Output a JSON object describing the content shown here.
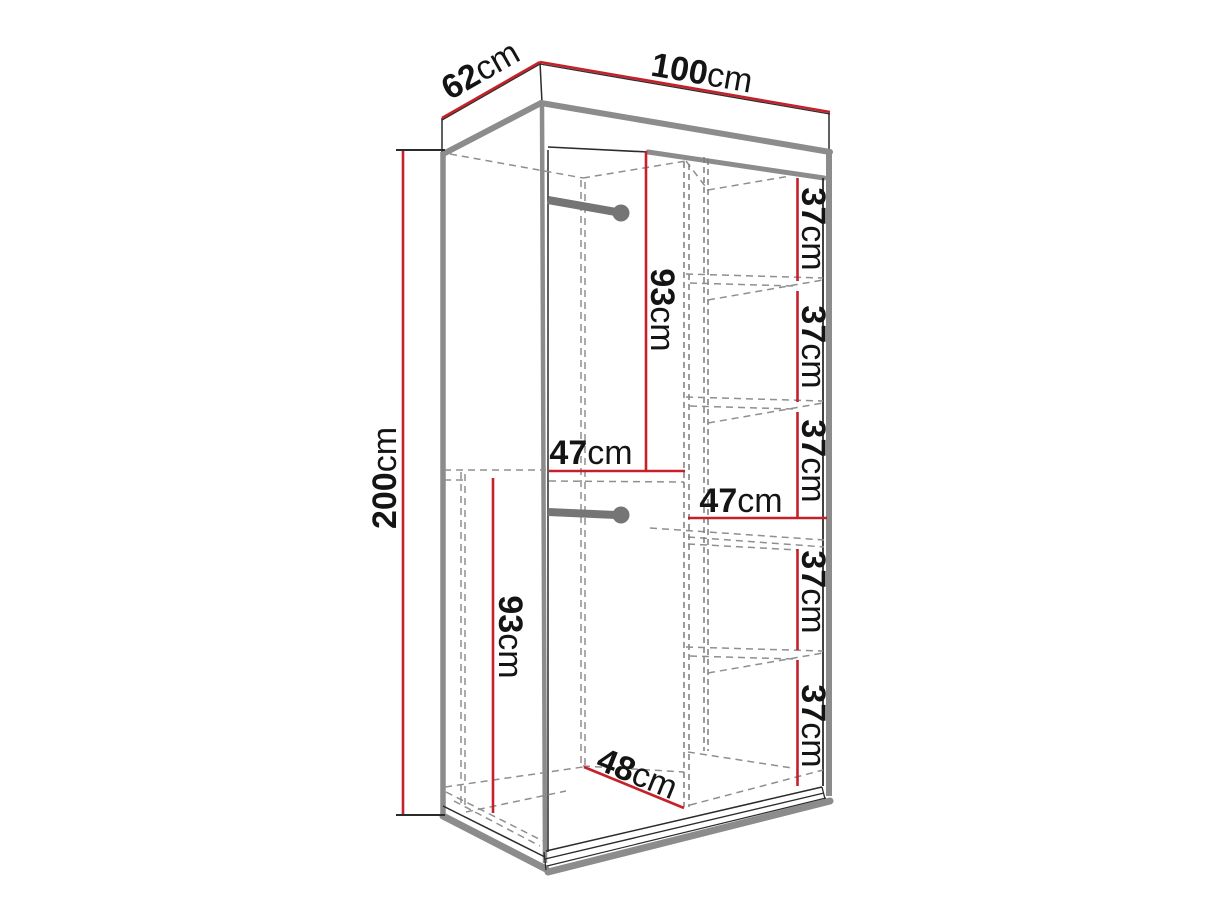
{
  "title": "Wardrobe dimension diagram",
  "colors": {
    "dimension_red": "#c5212a",
    "outline_black": "#2b2b2b",
    "panel_gray": "#8c8c8c",
    "rod_gray": "#757575",
    "hidden_dash_gray": "#8f8f8f",
    "text": "#141414",
    "background": "#ffffff"
  },
  "labels": {
    "depth": {
      "value": "62",
      "unit": "cm"
    },
    "width": {
      "value": "100",
      "unit": "cm"
    },
    "height": {
      "value": "200",
      "unit": "cm"
    },
    "hang_top": {
      "value": "93",
      "unit": "cm"
    },
    "hang_bottom": {
      "value": "93",
      "unit": "cm"
    },
    "inner_width_left": {
      "value": "47",
      "unit": "cm"
    },
    "inner_width_right": {
      "value": "47",
      "unit": "cm"
    },
    "floor_width": {
      "value": "48",
      "unit": "cm"
    },
    "shelves": [
      {
        "value": "37",
        "unit": "cm"
      },
      {
        "value": "37",
        "unit": "cm"
      },
      {
        "value": "37",
        "unit": "cm"
      },
      {
        "value": "37",
        "unit": "cm"
      },
      {
        "value": "37",
        "unit": "cm"
      }
    ]
  }
}
